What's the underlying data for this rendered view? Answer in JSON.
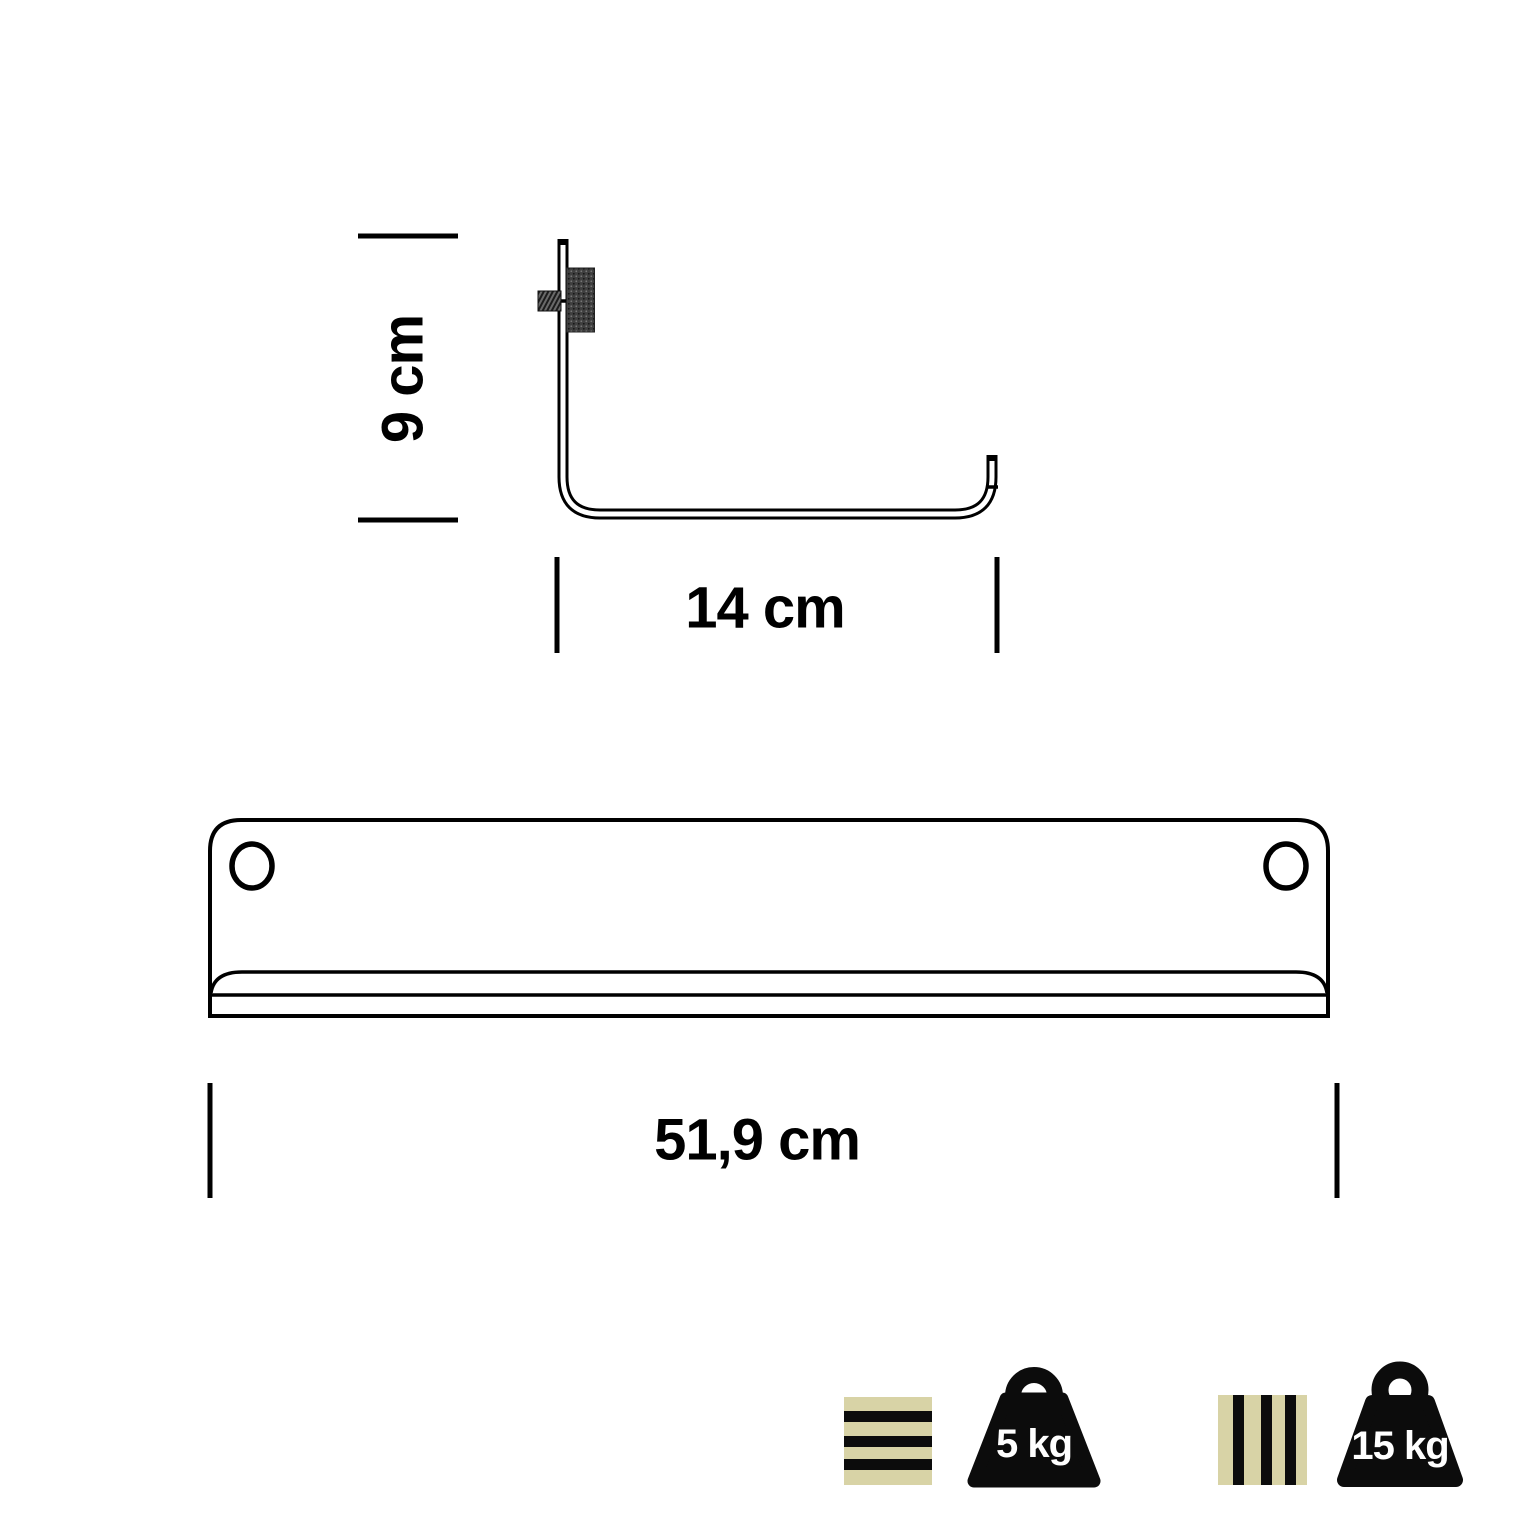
{
  "diagram": {
    "title": "wall-shelf-dimensions",
    "dimensions": {
      "bracket_height": "9 cm",
      "bracket_depth": "14 cm",
      "shelf_width": "51,9 cm"
    },
    "capacity": {
      "horizontal_slats_load": "5 kg",
      "vertical_slats_load": "15 kg"
    },
    "colors": {
      "line": "#000000",
      "slat_fill": "#d8d3a6",
      "weight_fill": "#0c0c0c",
      "knurl_fill": "#3f3f3f",
      "thread_fill": "#555555",
      "background": "#ffffff"
    }
  }
}
